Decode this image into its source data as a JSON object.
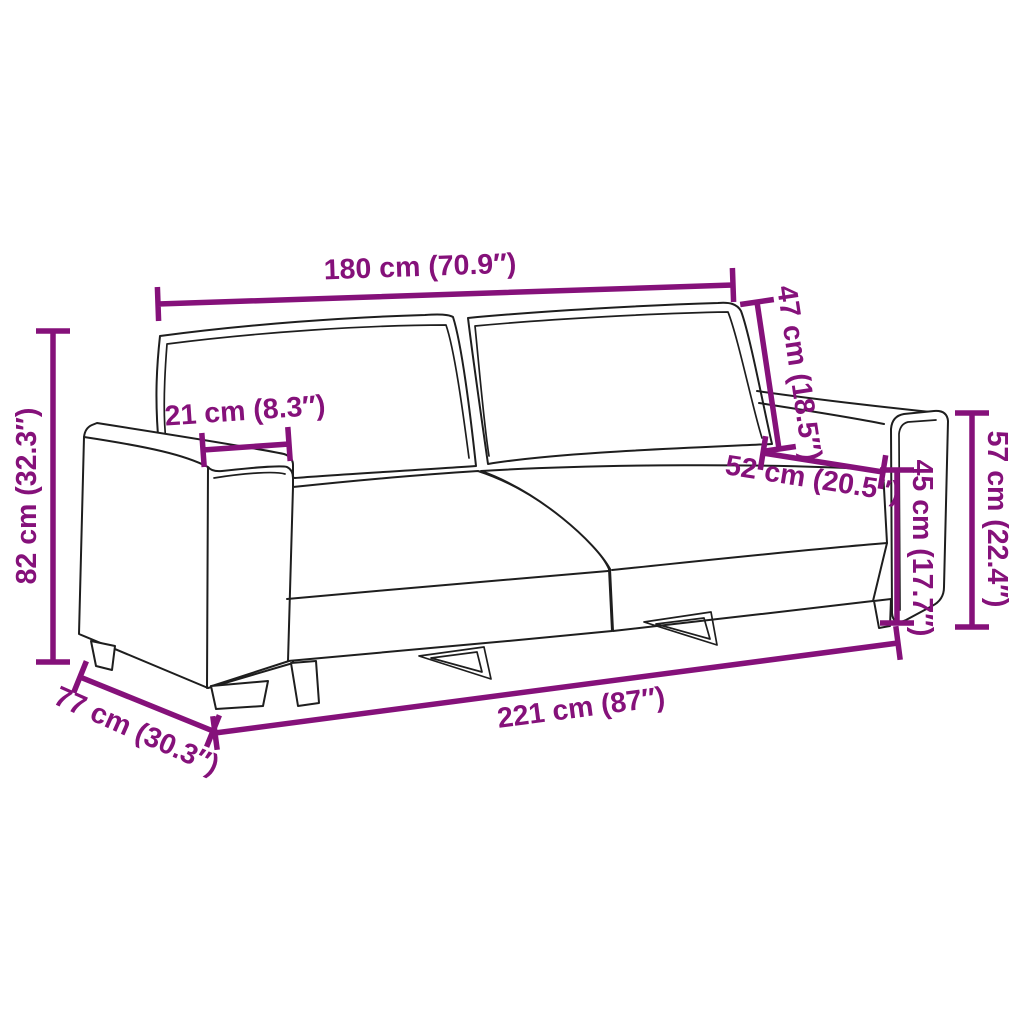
{
  "page": {
    "background_color": "#ffffff",
    "accent_color": "#85117A",
    "line_color": "#1e1e1e"
  },
  "diagram": {
    "type": "product-dimension-diagram",
    "subject": "two-seat modular sofa line drawing with measurement annotations",
    "dimensions": [
      {
        "id": "top-width",
        "label": "180 cm (70.9″)",
        "value_cm": 180,
        "value_in": 70.9
      },
      {
        "id": "backrest-height",
        "label": "47 cm (18.5″)",
        "value_cm": 47,
        "value_in": 18.5
      },
      {
        "id": "armrest-width",
        "label": "21 cm (8.3″)",
        "value_cm": 21,
        "value_in": 8.3
      },
      {
        "id": "overall-height",
        "label": "82 cm (32.3″)",
        "value_cm": 82,
        "value_in": 32.3
      },
      {
        "id": "seat-depth",
        "label": "52 cm (20.5″)",
        "value_cm": 52,
        "value_in": 20.5
      },
      {
        "id": "seat-height",
        "label": "45 cm (17.7″)",
        "value_cm": 45,
        "value_in": 17.7
      },
      {
        "id": "armrest-height",
        "label": "57 cm (22.4″)",
        "value_cm": 57,
        "value_in": 22.4
      },
      {
        "id": "overall-depth",
        "label": "77 cm (30.3″)",
        "value_cm": 77,
        "value_in": 30.3
      },
      {
        "id": "overall-width",
        "label": "221 cm (87″)",
        "value_cm": 221,
        "value_in": 87
      }
    ]
  }
}
